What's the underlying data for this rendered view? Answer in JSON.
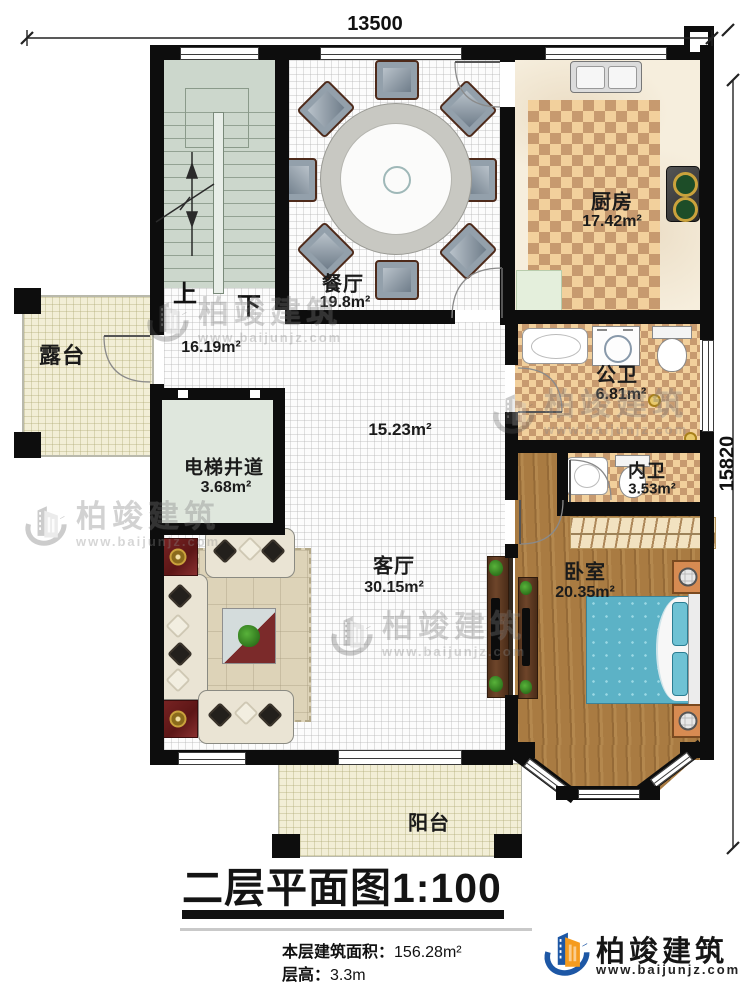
{
  "dimensions": {
    "top": "13500",
    "right": "15820"
  },
  "rooms": {
    "stairwell": {
      "up": "上",
      "down": "下",
      "area": "16.19m²"
    },
    "dining": {
      "name": "餐厅",
      "area": "19.8m²"
    },
    "kitchen": {
      "name": "厨房",
      "area": "17.42m²"
    },
    "terrace": {
      "name": "露台"
    },
    "elevator": {
      "name": "电梯井道",
      "area": "3.68m²"
    },
    "hall": {
      "area": "15.23m²"
    },
    "public_bath": {
      "name": "公卫",
      "area": "6.81m²"
    },
    "ensuite_bath": {
      "name": "内卫",
      "area": "3.53m²"
    },
    "living": {
      "name": "客厅",
      "area": "30.15m²"
    },
    "bedroom": {
      "name": "卧室",
      "area": "20.35m²"
    },
    "balcony": {
      "name": "阳台"
    }
  },
  "title": {
    "text": "二层平面图",
    "scale": "1:100"
  },
  "footer": {
    "area_label": "本层建筑面积：",
    "area_value": "156.28m²",
    "height_label": "层高：",
    "height_value": "3.3m"
  },
  "brand": {
    "name": "柏竣建筑",
    "website": "www.baijunjz.com"
  },
  "watermark": {
    "name": "柏竣建筑",
    "website": "www.baijunjz.com"
  },
  "colors": {
    "wall": "#0d0d0d",
    "wood_floor": "#a97b42",
    "tile_light": "#f2d09c",
    "tile_dark": "#c79a6f",
    "bed": "#5cb2c6",
    "stair_floor": "#ccd7cc",
    "terrace_floor": "#f2eed6",
    "logo_blue": "#1d57a5",
    "logo_orange": "#f59b1e"
  }
}
